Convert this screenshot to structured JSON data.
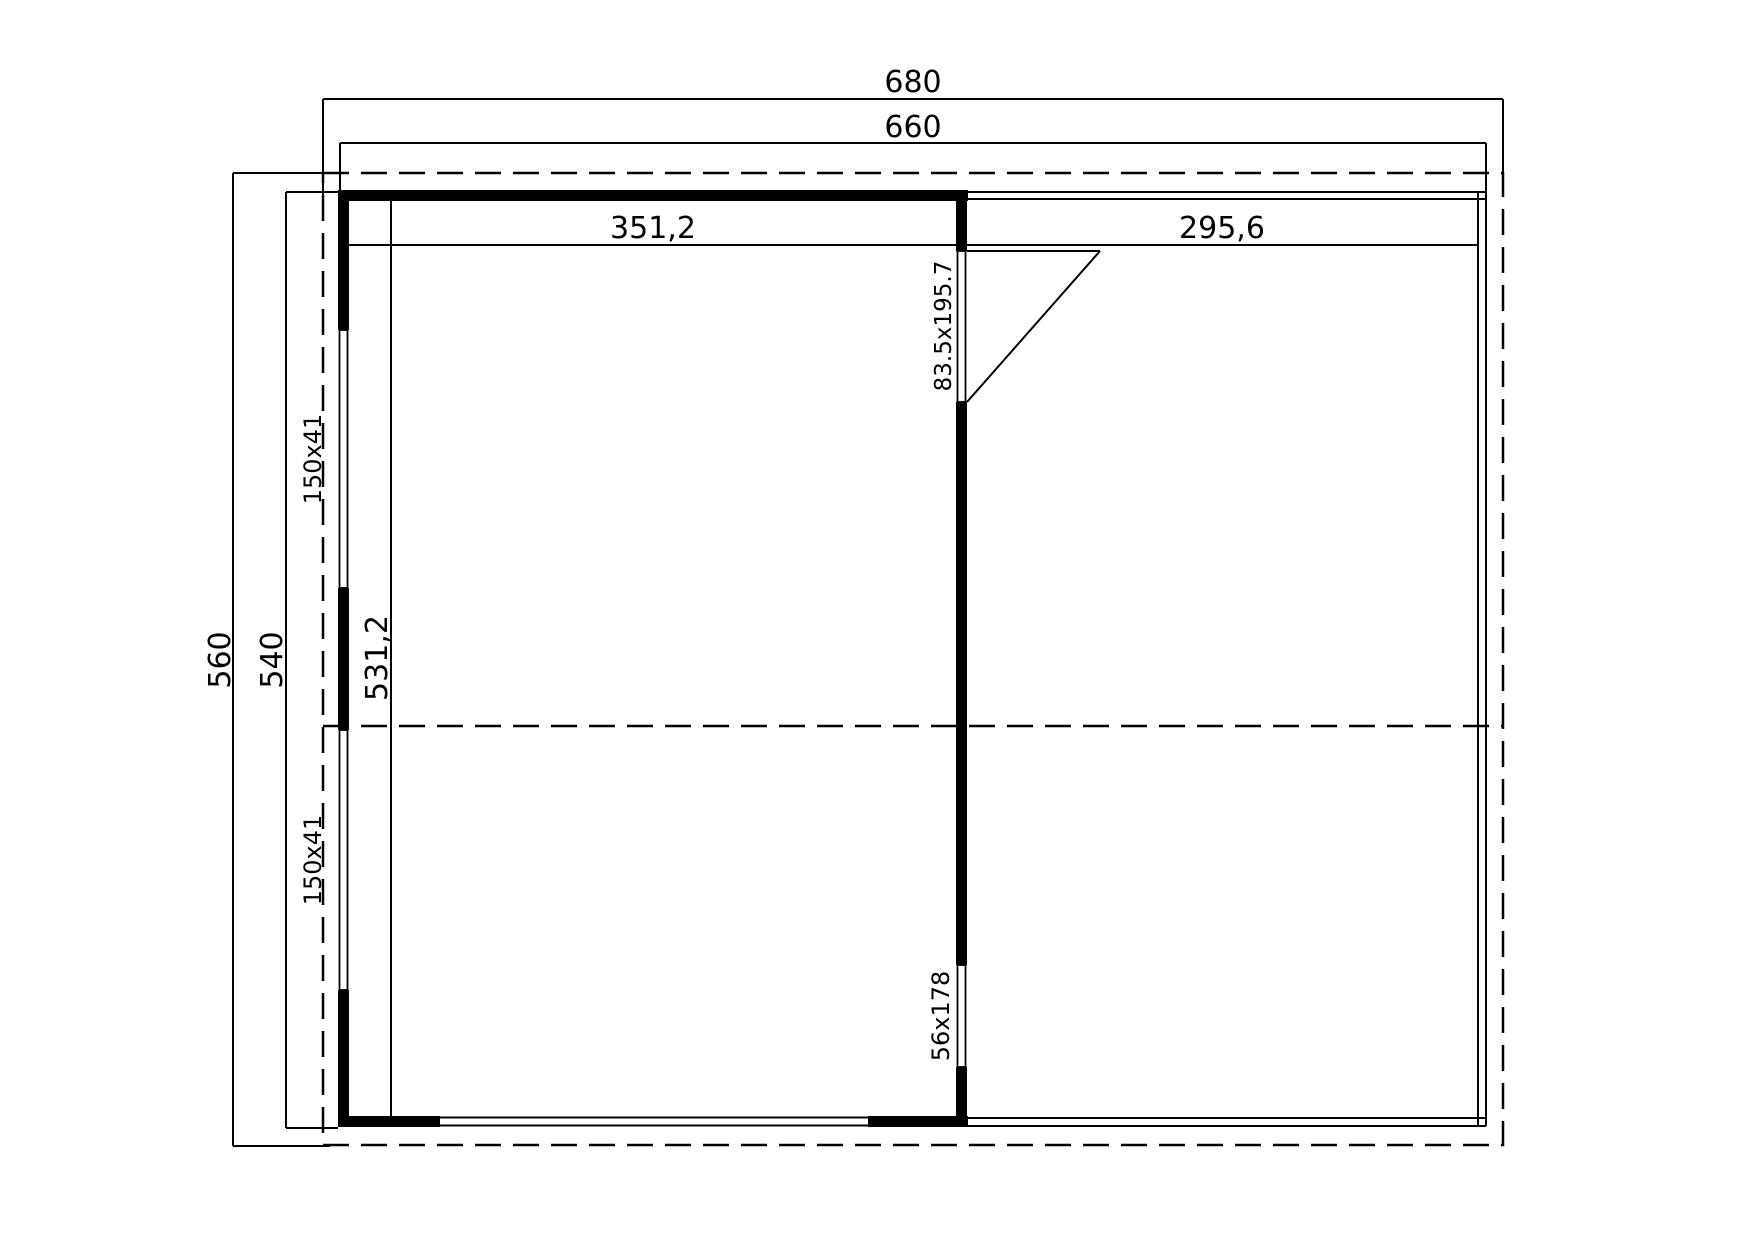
{
  "drawing": {
    "background_color": "#ffffff",
    "line_color": "#000000",
    "dims": {
      "roof_width": "680",
      "outer_width": "660",
      "roof_depth": "560",
      "outer_depth": "540",
      "left_room_width": "351,2",
      "right_room_width": "295,6",
      "interior_depth": "531,2"
    },
    "openings": {
      "window_upper": "150x41",
      "window_lower": "150x41",
      "side_door": "83.5x195.7",
      "back_door": "56x178"
    }
  }
}
